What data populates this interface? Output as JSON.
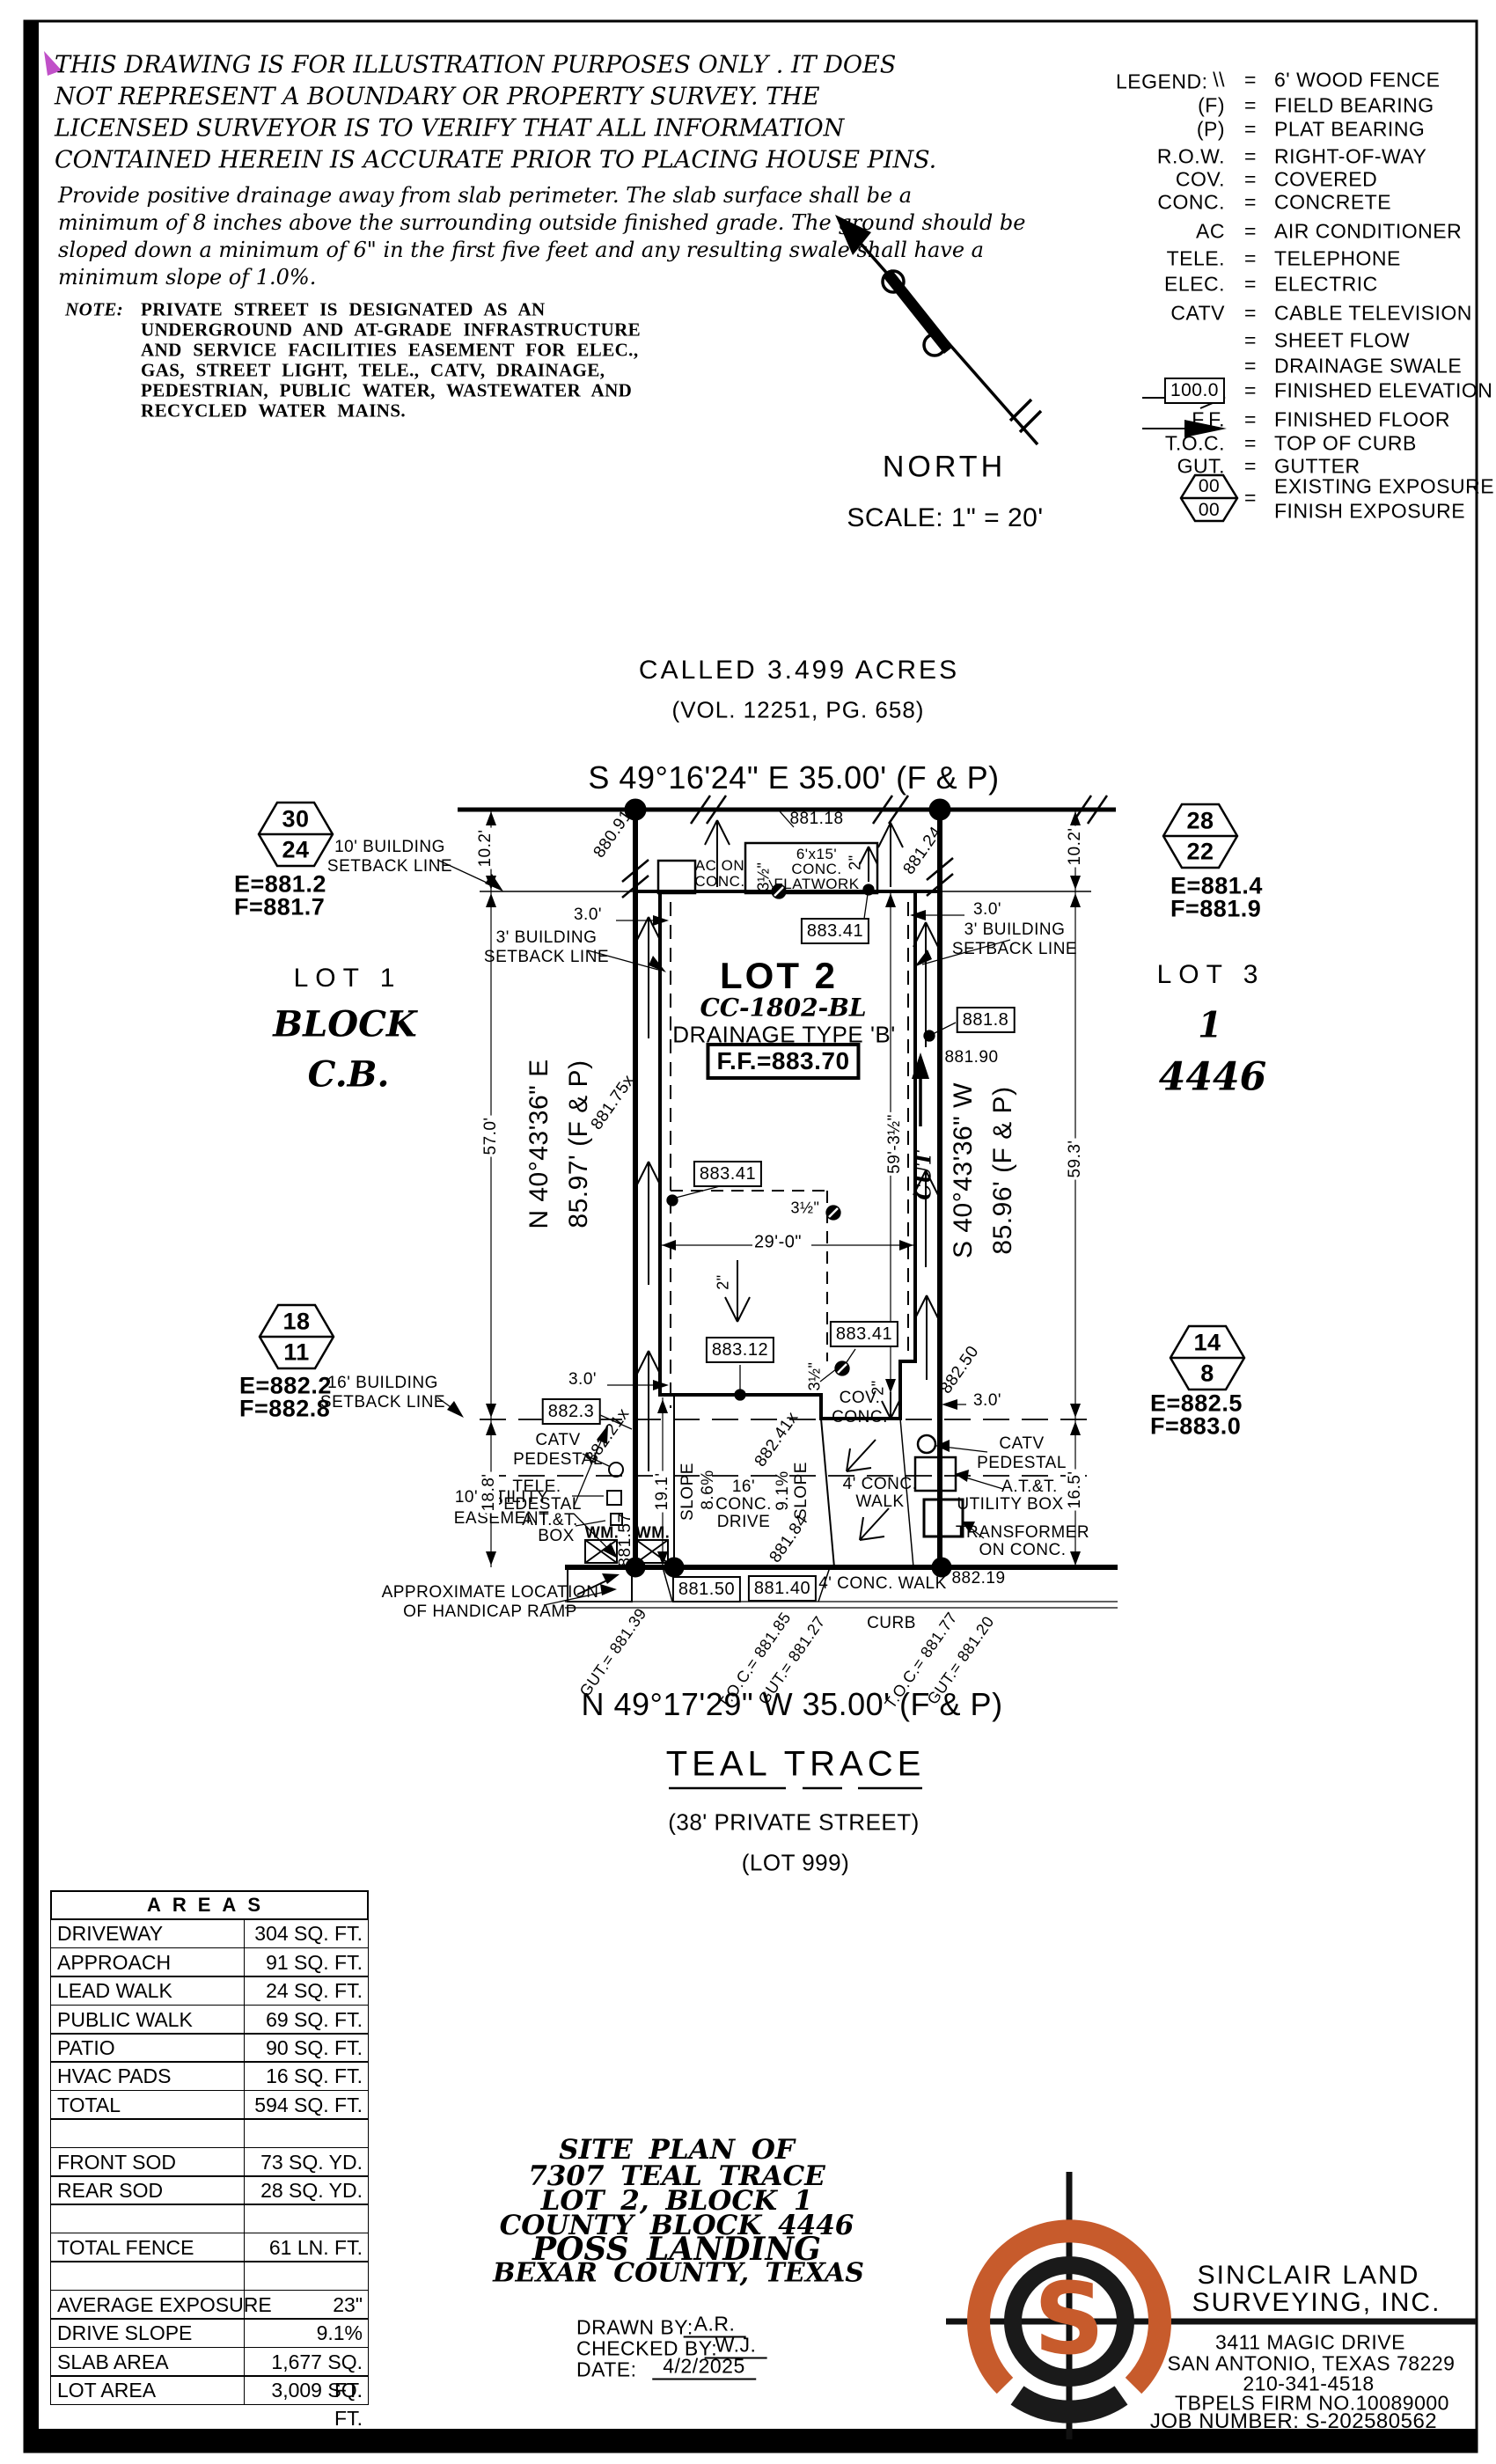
{
  "page": {
    "disclaimer": [
      "THIS DRAWING IS FOR ILLUSTRATION PURPOSES ONLY . IT DOES",
      "NOT REPRESENT A BOUNDARY OR PROPERTY SURVEY. THE",
      "LICENSED SURVEYOR IS TO VERIFY THAT ALL INFORMATION",
      "CONTAINED HEREIN IS ACCURATE PRIOR TO PLACING HOUSE PINS."
    ],
    "drainage_note": [
      "Provide positive drainage away from slab perimeter. The slab surface shall be a",
      "minimum of 8 inches above the surrounding outside finished grade. The ground should be",
      "sloped down a minimum of 6\" in the first five feet and any resulting swale shall have a",
      "minimum slope of 1.0%."
    ],
    "note_label": "NOTE:",
    "note": [
      "PRIVATE STREET IS DESIGNATED AS AN",
      "UNDERGROUND AND AT-GRADE INFRASTRUCTURE",
      "AND SERVICE FACILITIES EASEMENT FOR ELEC.,",
      "GAS, STREET LIGHT, TELE., CATV, DRAINAGE,",
      "PEDESTRIAN, PUBLIC WATER, WASTEWATER AND",
      "RECYCLED WATER MAINS."
    ],
    "north": "NORTH",
    "scale": "SCALE: 1\" = 20'"
  },
  "legend": {
    "title": "LEGEND:",
    "eq": "=",
    "items": [
      {
        "sym": "\\\\",
        "desc": "6' WOOD FENCE"
      },
      {
        "sym": "(F)",
        "desc": "FIELD BEARING"
      },
      {
        "sym": "(P)",
        "desc": "PLAT BEARING"
      },
      {
        "sym": "R.O.W.",
        "desc": "RIGHT-OF-WAY"
      },
      {
        "sym": "COV.",
        "desc": "COVERED"
      },
      {
        "sym": "CONC.",
        "desc": "CONCRETE"
      },
      {
        "sym": "AC",
        "desc": "AIR CONDITIONER"
      },
      {
        "sym": "TELE.",
        "desc": "TELEPHONE"
      },
      {
        "sym": "ELEC.",
        "desc": "ELECTRIC"
      },
      {
        "sym": "CATV",
        "desc": "CABLE TELEVISION"
      },
      {
        "sym": "",
        "desc": "SHEET FLOW"
      },
      {
        "sym": "",
        "desc": "DRAINAGE SWALE"
      },
      {
        "sym": "100.0",
        "desc": "FINISHED ELEVATION"
      },
      {
        "sym": "F.F.",
        "desc": "FINISHED FLOOR"
      },
      {
        "sym": "T.O.C.",
        "desc": "TOP OF CURB"
      },
      {
        "sym": "GUT.",
        "desc": "GUTTER"
      }
    ],
    "exposure_top": "00",
    "exposure_bottom": "00",
    "exposure_desc1": "EXISTING EXPOSURE",
    "exposure_desc2": "FINISH EXPOSURE"
  },
  "parcel": {
    "called": "CALLED 3.499 ACRES",
    "volume": "(VOL. 12251, PG. 658)",
    "bearing_top": "S 49°16'24\" E 35.00' (F & P)",
    "bearing_bottom": "N 49°17'29\" W 35.00' (F & P)",
    "bearing_left_1": "N 40°43'36\" E",
    "bearing_left_2": "85.97' (F & P)",
    "bearing_right_1": "S 40°43'36\" W",
    "bearing_right_2": "85.96' (F & P)",
    "street_name": "TEAL TRACE",
    "street_type": "(38' PRIVATE STREET)",
    "street_lot": "(LOT 999)",
    "lot1": "LOT 1",
    "lot3": "LOT 3",
    "block_word": "BLOCK",
    "block_num": "1",
    "cb_word": "C.B.",
    "cb_num": "4446",
    "lot2": "LOT 2",
    "plan_code": "CC-1802-BL",
    "drainage_type": "DRAINAGE TYPE 'B'",
    "ff": "F.F.=883.70"
  },
  "markers": [
    {
      "top": "30",
      "bottom": "24",
      "e": "E=881.2",
      "f": "F=881.7"
    },
    {
      "top": "28",
      "bottom": "22",
      "e": "E=881.4",
      "f": "F=881.9"
    },
    {
      "top": "18",
      "bottom": "11",
      "e": "E=882.2",
      "f": "F=882.8"
    },
    {
      "top": "14",
      "bottom": "8",
      "e": "E=882.5",
      "f": "F=883.0"
    }
  ],
  "plat": {
    "setback10": [
      "10' BUILDING",
      "SETBACK LINE"
    ],
    "setback3": [
      "3' BUILDING",
      "SETBACK LINE"
    ],
    "setback16": [
      "16' BUILDING",
      "SETBACK LINE"
    ],
    "utility": [
      "10' UTILITY",
      "EASEMENT"
    ],
    "handicap": [
      "APPROXIMATE LOCATION",
      "OF HANDICAP RAMP"
    ],
    "catv_ped": [
      "CATV",
      "PEDESTAL"
    ],
    "tele_ped": [
      "TELE.",
      "PEDESTAL"
    ],
    "att_box": [
      "A.T.&T.",
      "BOX"
    ],
    "att_utility": [
      "A.T.&T.",
      "UTILITY BOX"
    ],
    "transformer": [
      "TRANSFORMER",
      "ON CONC."
    ],
    "ac_pad": [
      "AC ON",
      "CONC."
    ],
    "flatwork": [
      "6'x15'",
      "CONC.",
      "FLATWORK"
    ],
    "drive": [
      "16'",
      "CONC.",
      "DRIVE"
    ],
    "cov_conc": [
      "COV.",
      "CONC."
    ],
    "walk_lead": [
      "4' CONC.",
      "WALK"
    ],
    "walk_public": "4' CONC. WALK",
    "curb": "CURB",
    "wm": "WM.",
    "cut": "CUT",
    "slope_word": "SLOPE",
    "slope_86": "8.6%",
    "slope_91": "9.1%",
    "dim_10_2": "10.2'",
    "dim_57": "57.0'",
    "dim_18_8": "18.8'",
    "dim_59_3": "59.3'",
    "dim_16_5": "16.5'",
    "dim_59_3h": "59'-3½\"",
    "dim_29": "29'-0\"",
    "dim_19_1": "19.1'",
    "dim_3": "3.0'",
    "dim_2in": "2\"",
    "dim_3hin": "3½\"",
    "el_880_91": "880.91",
    "el_881_18": "881.18",
    "el_881_24": "881.24",
    "el_881_75": "881.75x",
    "el_881_90": "881.90",
    "el_882_21": "882.21x",
    "el_882_41": "882.41x",
    "el_882_50": "882.50",
    "el_881_57": "881.57",
    "el_881_84": "881.84",
    "el_882_19": "882.19",
    "box_883_41": "883.41",
    "box_883_12": "883.12",
    "box_882_3": "882.3",
    "box_881_8": "881.8",
    "box_881_50": "881.50",
    "box_881_40": "881.40",
    "gut_1": "GUT.= 881.39",
    "toc_1": "T.O.C.= 881.85",
    "gut_2": "GUT.= 881.27",
    "toc_2": "T.O.C.= 881.77",
    "gut_3": "GUT.= 881.20"
  },
  "areas": {
    "title": "AREAS",
    "rows": [
      {
        "label": "DRIVEWAY",
        "value": "304 SQ. FT."
      },
      {
        "label": "APPROACH",
        "value": "91 SQ. FT."
      },
      {
        "label": "LEAD WALK",
        "value": "24 SQ. FT."
      },
      {
        "label": "PUBLIC WALK",
        "value": "69 SQ. FT."
      },
      {
        "label": "PATIO",
        "value": "90 SQ. FT."
      },
      {
        "label": "HVAC PADS",
        "value": "16 SQ. FT."
      },
      {
        "label": "TOTAL",
        "value": "594 SQ. FT."
      },
      {
        "label": "",
        "value": ""
      },
      {
        "label": "FRONT SOD",
        "value": "73 SQ. YD."
      },
      {
        "label": "REAR SOD",
        "value": "28 SQ. YD."
      },
      {
        "label": "",
        "value": ""
      },
      {
        "label": "TOTAL FENCE",
        "value": "61 LN. FT."
      },
      {
        "label": "",
        "value": ""
      },
      {
        "label": "AVERAGE EXPOSURE",
        "value": "23\""
      },
      {
        "label": "DRIVE SLOPE",
        "value": "9.1%"
      },
      {
        "label": "SLAB AREA",
        "value": "1,677 SQ. FT."
      },
      {
        "label": "LOT AREA",
        "value": "3,009 SQ. FT."
      }
    ]
  },
  "titleblock": {
    "line1": "SITE PLAN OF",
    "line2": "7307 TEAL TRACE",
    "line3": "LOT 2, BLOCK 1",
    "line4": "COUNTY BLOCK 4446",
    "line5": "POSS LANDING",
    "line6": "BEXAR COUNTY, TEXAS",
    "drawn_label": "DRAWN BY:",
    "drawn": "A.R.",
    "checked_label": "CHECKED BY:",
    "checked": "W.J.",
    "date_label": "DATE:",
    "date": "4/2/2025"
  },
  "firm": {
    "monogram": "S",
    "name1": "SINCLAIR LAND",
    "name2": "SURVEYING, INC.",
    "addr1": "3411 MAGIC DRIVE",
    "addr2": "SAN ANTONIO, TEXAS 78229",
    "phone": "210-341-4518",
    "firm_no": "TBPELS FIRM NO.10089000",
    "job": "JOB NUMBER: S-202580562"
  },
  "colors": {
    "ink": "#000000",
    "accent_orange": "#C75B2C",
    "marker_magenta": "#C050C8"
  }
}
